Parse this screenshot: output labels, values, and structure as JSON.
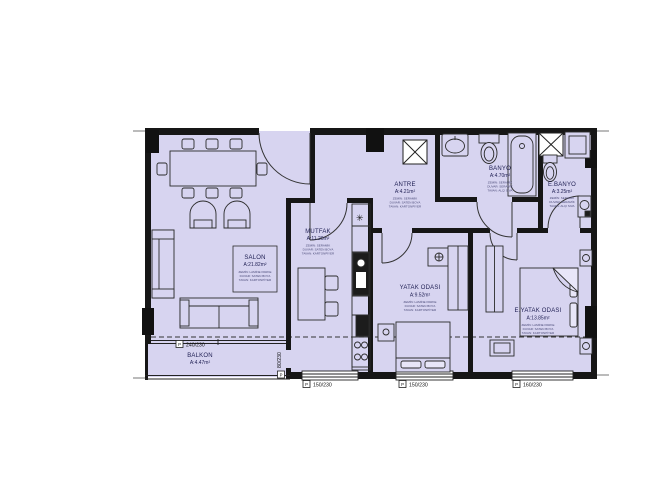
{
  "rooms": {
    "salon": {
      "name": "SALON",
      "area": "A:21.82m²",
      "notes": [
        "ZEMİN: LAMİNE PARKE",
        "DUVAR: SATEN BOYA",
        "TAVAN: KARTONPİYER"
      ]
    },
    "mutfak": {
      "name": "MUTFAK",
      "area": "A:11.20m²",
      "notes": [
        "ZEMİN: SERAMİK",
        "DUVAR: SATEN BOYA",
        "TAVAN: KARTONPİYER"
      ]
    },
    "antre": {
      "name": "ANTRE",
      "area": "A:4.21m²",
      "notes": [
        "ZEMİN: SERAMİK",
        "DUVAR: SATEN BOYA",
        "TAVAN: KARTONPİYER"
      ]
    },
    "banyo": {
      "name": "BANYO",
      "area": "A:4.70m²",
      "notes": [
        "ZEMİN: SERAMİK",
        "DUVAR: SERAMİK",
        "TAVAN: ALÇI SIVA"
      ]
    },
    "ebanyo": {
      "name": "E.BANYO",
      "area": "A:3.25m²",
      "notes": [
        "ZEMİN: SERAMİK",
        "DUVAR: SERAMİK",
        "TAVAN: ALÇI SIVA"
      ]
    },
    "yatak": {
      "name": "YATAK ODASI",
      "area": "A:9.52m²",
      "notes": [
        "ZEMİN: LAMİNE PARKE",
        "DUVAR: SATEN BOYA",
        "TAVAN: KARTONPİYER"
      ]
    },
    "eyatak": {
      "name": "E.YATAK ODASI",
      "area": "A:13.85m²",
      "notes": [
        "ZEMİN: LAMİNE PARKE",
        "DUVAR: SATEN BOYA",
        "TAVAN: KARTONPİYER"
      ]
    },
    "balkon": {
      "name": "BALKON",
      "area": "A:4.47m²"
    }
  },
  "openings": {
    "flag": "P",
    "balcony_slider": "240/230",
    "balcony_side_door": "80/230",
    "window_kitchen": "150/230",
    "window_bedroom": "150/230",
    "window_master": "160/230"
  },
  "symbols": {
    "lamp": "✳"
  },
  "colors": {
    "floor": "#d7d4f0",
    "wall": "#161616"
  }
}
